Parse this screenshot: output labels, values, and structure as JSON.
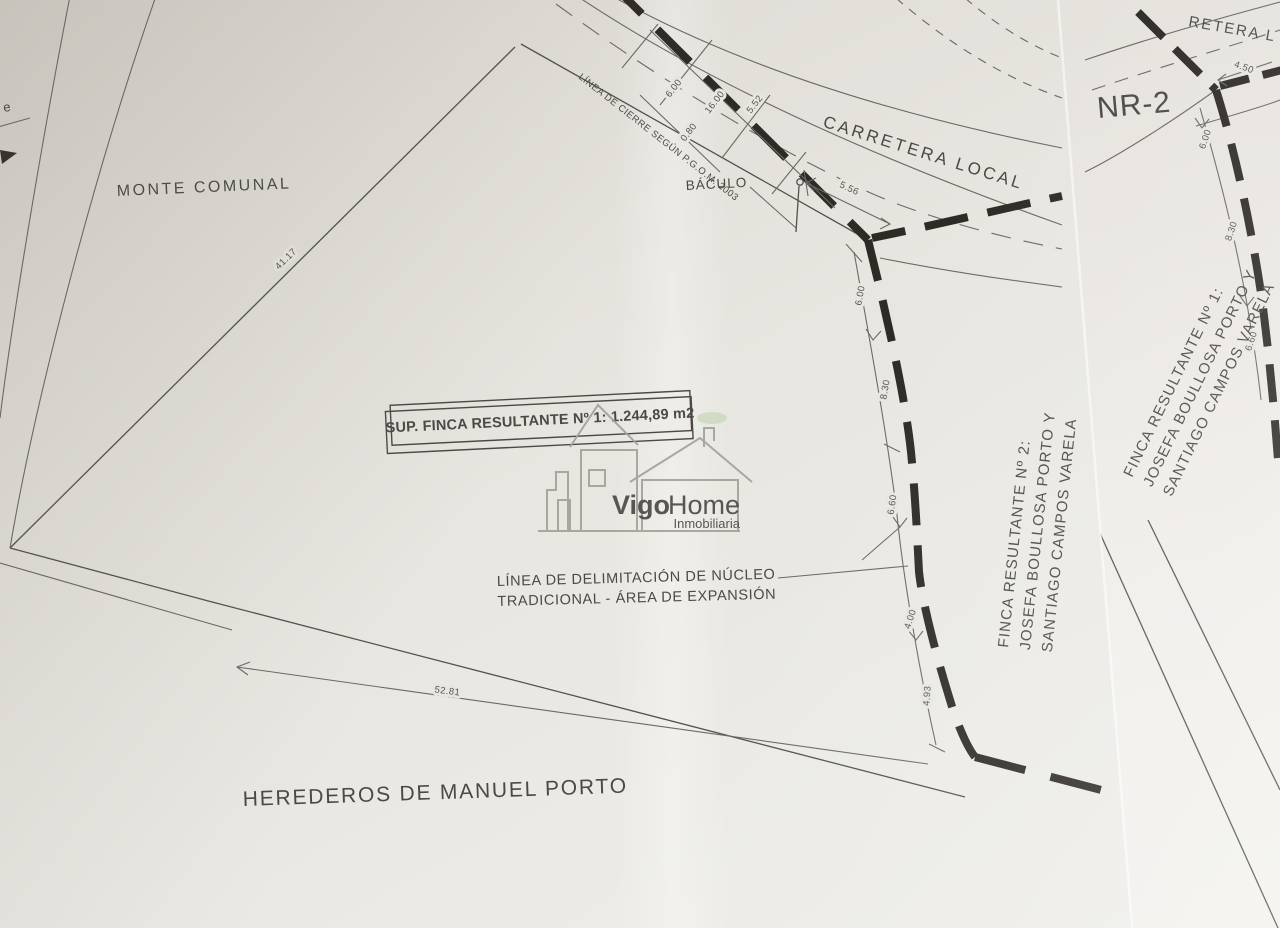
{
  "plan": {
    "area_labels": {
      "monte_comunal": "MONTE COMUNAL",
      "herederos": "HEREDEROS DE MANUEL PORTO",
      "carretera_local": "CARRETERA LOCAL",
      "carretera_local_partial": "RETERA L"
    },
    "feature_labels": {
      "baculo": "BÁCULO",
      "linea_cierre": "LÍNEA DE CIERRE SEGÚN P.G.O.M. 2003",
      "delimitacion_line1": "LÍNEA DE DELIMITACIÓN DE NÚCLEO",
      "delimitacion_line2": "TRADICIONAL - ÁREA DE EXPANSIÓN",
      "edge_partial": "e"
    },
    "parcel_box": {
      "label": "SUP. FINCA RESULTANTE Nº 1: 1.244,89 m2"
    },
    "sheet_label": "NR-2",
    "owner_block_finca2": {
      "line1": "FINCA RESULTANTE Nº 2:",
      "line2": "JOSEFA BOULLOSA PORTO Y",
      "line3": "SANTIAGO CAMPOS VARELA"
    },
    "owner_block_finca1": {
      "line1": "FINCA RESULTANTE Nº 1:",
      "line2": "JOSEFA BOULLOSA PORTO Y",
      "line3": "SANTIAGO CAMPOS VARELA"
    },
    "dimensions": {
      "upper_left": "41.17",
      "bottom": "52.81",
      "road_cross": [
        "6.00",
        "16.00",
        "5.52",
        "0.80"
      ],
      "road_width": "5.56",
      "east_chain": [
        "6.00",
        "8.30",
        "6.60",
        "4.00",
        "4.93"
      ],
      "nr2_chain": [
        "4.50",
        "6.00",
        "8.30",
        "6.60"
      ]
    }
  },
  "watermark": {
    "brand_primary": "Vigo",
    "brand_secondary": "Home",
    "tagline": "Inmobiliaria"
  },
  "colors": {
    "ink": "#4b4945",
    "heavy_ink": "#2e2a25",
    "watermark_gray": "#a3a19b",
    "paper_left": "#e6e3dd",
    "paper_right": "#edebe7"
  }
}
